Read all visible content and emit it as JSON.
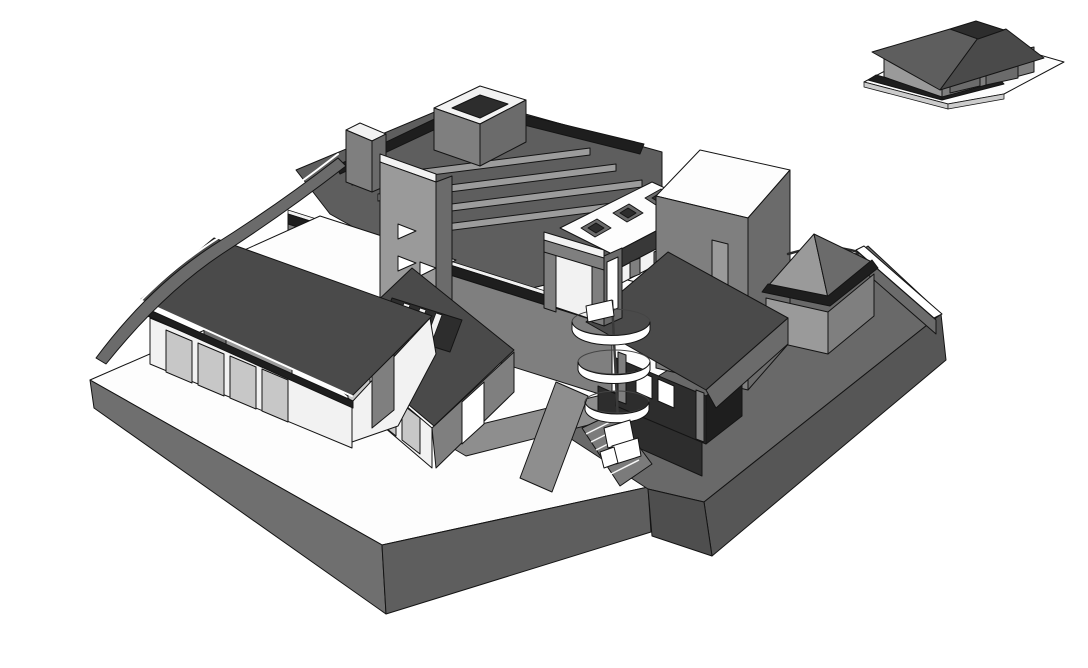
{
  "scene": {
    "description": "Monochrome 3D architectural massing model of a villa complex on a stepped plinth with a detached hip-roof outbuilding at upper right",
    "background": "#ffffff"
  },
  "palette": {
    "background": "#ffffff",
    "white": "#ffffff",
    "offWhite": "#f2f2f2",
    "plateEdge": "#cccccc",
    "glass": "#c7c7c7",
    "wallLight": "#9a9a9a",
    "wall": "#7f7f7f",
    "wallShade": "#6b6b6b",
    "roof": "#4a4a4a",
    "roofLight": "#5e5e5e",
    "roofDark": "#383838",
    "darkBand": "#1e1e1e",
    "darkWall": "#2d2d2d",
    "plinthTop": "#fdfdfd",
    "plinthSide": "#6f6f6f",
    "plinthShade": "#5e5e5e",
    "terrace": "#696969",
    "terraceSide": "#565656",
    "cornerFace": "#4e4e4e",
    "path": "#8e8e8e",
    "beam": "#9c9c9c",
    "stair": "#7b7b7b",
    "outline": "#141414"
  },
  "parts": {
    "plinth": "ground plinth",
    "terrace": "sunken terrace",
    "left_wing": "left gabled wing",
    "middle_wing": "middle gabled wing with skylights",
    "central_block": "central two-storey block",
    "stair_tower": "stair tower",
    "spiral_stair": "spiral staircase",
    "right_wing": "right dark-walled wing",
    "flat_roof_box": "flat-roofed box",
    "pavilion": "hip-roof pavilion",
    "garage": "detached outbuilding"
  }
}
